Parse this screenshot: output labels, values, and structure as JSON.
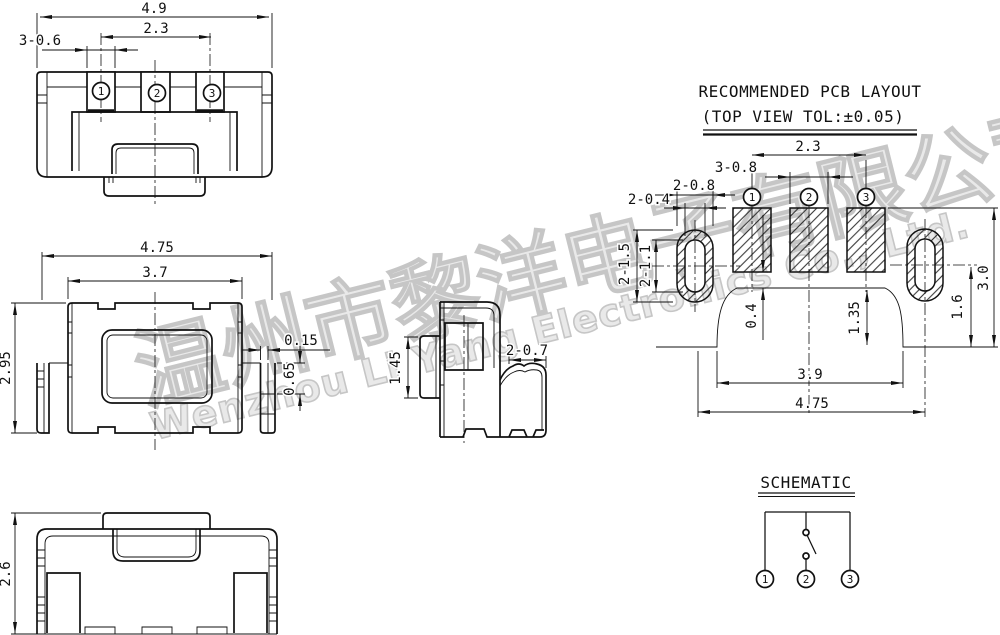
{
  "colors": {
    "line": "#111111",
    "watermark": "#c6c6c6",
    "background": "#ffffff"
  },
  "watermark": {
    "cn": "温州市黎洋电子有限公司",
    "en": "Wenzhou Li Yang Electronics Co., Ltd."
  },
  "terminals": {
    "t1": "1",
    "t2": "2",
    "t3": "3"
  },
  "top_view": {
    "dim_width": "4.9",
    "dim_pitch": "2.3",
    "dim_pad": "3-0.6"
  },
  "front_view": {
    "dim_width": "4.75",
    "dim_body": "3.7",
    "dim_height": "2.95",
    "dim_gap": "0.15",
    "dim_leg": "0.65"
  },
  "side_view": {
    "dim_stem": "1.45",
    "dim_foot": "2-0.7"
  },
  "bottom_view": {
    "dim_height": "2.6"
  },
  "pcb_layout": {
    "title_line1": "RECOMMENDED PCB LAYOUT",
    "title_line2": "(TOP VIEW TOL:±0.05)",
    "dim_pitch": "2.3",
    "dim_pad_w": "3-0.8",
    "dim_oval_w": "2-0.8",
    "dim_slot_w": "2-0.4",
    "dim_oval_l": "2-1.5",
    "dim_slot_l": "2-1.1",
    "dim_gap": "0.4",
    "dim_hump": "1.35",
    "dim_oval_y": "1.6",
    "dim_total_h": "3.0",
    "dim_inner_w": "3.9",
    "dim_outer_w": "4.75"
  },
  "schematic": {
    "title": "SCHEMATIC"
  }
}
